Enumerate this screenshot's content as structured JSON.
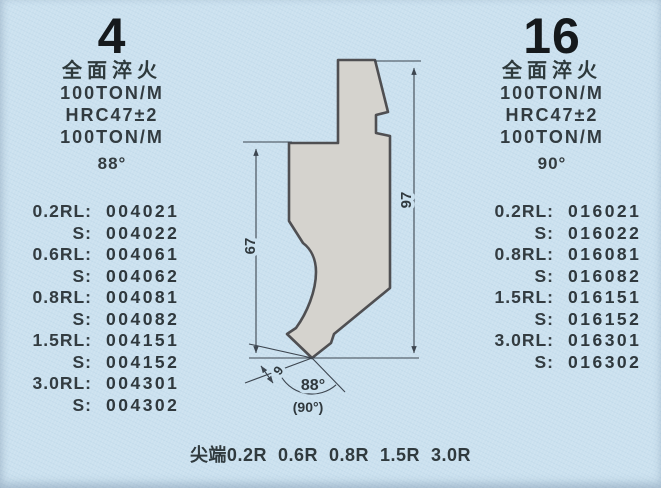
{
  "page": {
    "background": "#cbe1ef",
    "text_color": "#333b3f"
  },
  "left_panel": {
    "model": "4",
    "specs": [
      "全面淬火",
      "100TON/M",
      "HRC47±2",
      "100TON/M"
    ],
    "angle": "88°",
    "parts": [
      {
        "label": "0.2RL:",
        "value": "004021"
      },
      {
        "label": "S:",
        "value": "004022"
      },
      {
        "label": "0.6RL:",
        "value": "004061"
      },
      {
        "label": "S:",
        "value": "004062"
      },
      {
        "label": "0.8RL:",
        "value": "004081"
      },
      {
        "label": "S:",
        "value": "004082"
      },
      {
        "label": "1.5RL:",
        "value": "004151"
      },
      {
        "label": "S:",
        "value": "004152"
      },
      {
        "label": "3.0RL:",
        "value": "004301"
      },
      {
        "label": "S:",
        "value": "004302"
      }
    ]
  },
  "right_panel": {
    "model": "16",
    "specs": [
      "全面淬火",
      "100TON/M",
      "HRC47±2",
      "100TON/M"
    ],
    "angle": "90°",
    "parts": [
      {
        "label": "0.2RL:",
        "value": "016021"
      },
      {
        "label": "S:",
        "value": "016022"
      },
      {
        "label": "0.8RL:",
        "value": "016081"
      },
      {
        "label": "S:",
        "value": "016082"
      },
      {
        "label": "1.5RL:",
        "value": "016151"
      },
      {
        "label": "S:",
        "value": "016152"
      },
      {
        "label": "3.0RL:",
        "value": "016301"
      },
      {
        "label": "S:",
        "value": "016302"
      }
    ]
  },
  "drawing": {
    "dim_left_height": "67",
    "dim_right_height": "97",
    "dim_tip": "9",
    "tip_angle": "88°",
    "tip_angle_alt": "(90°)",
    "punch_fill": "#d5d3ce",
    "punch_outline": "#4f4f52",
    "dim_color": "#3d4650"
  },
  "footer": {
    "caption": "尖端0.2R  0.6R  0.8R  1.5R  3.0R"
  }
}
